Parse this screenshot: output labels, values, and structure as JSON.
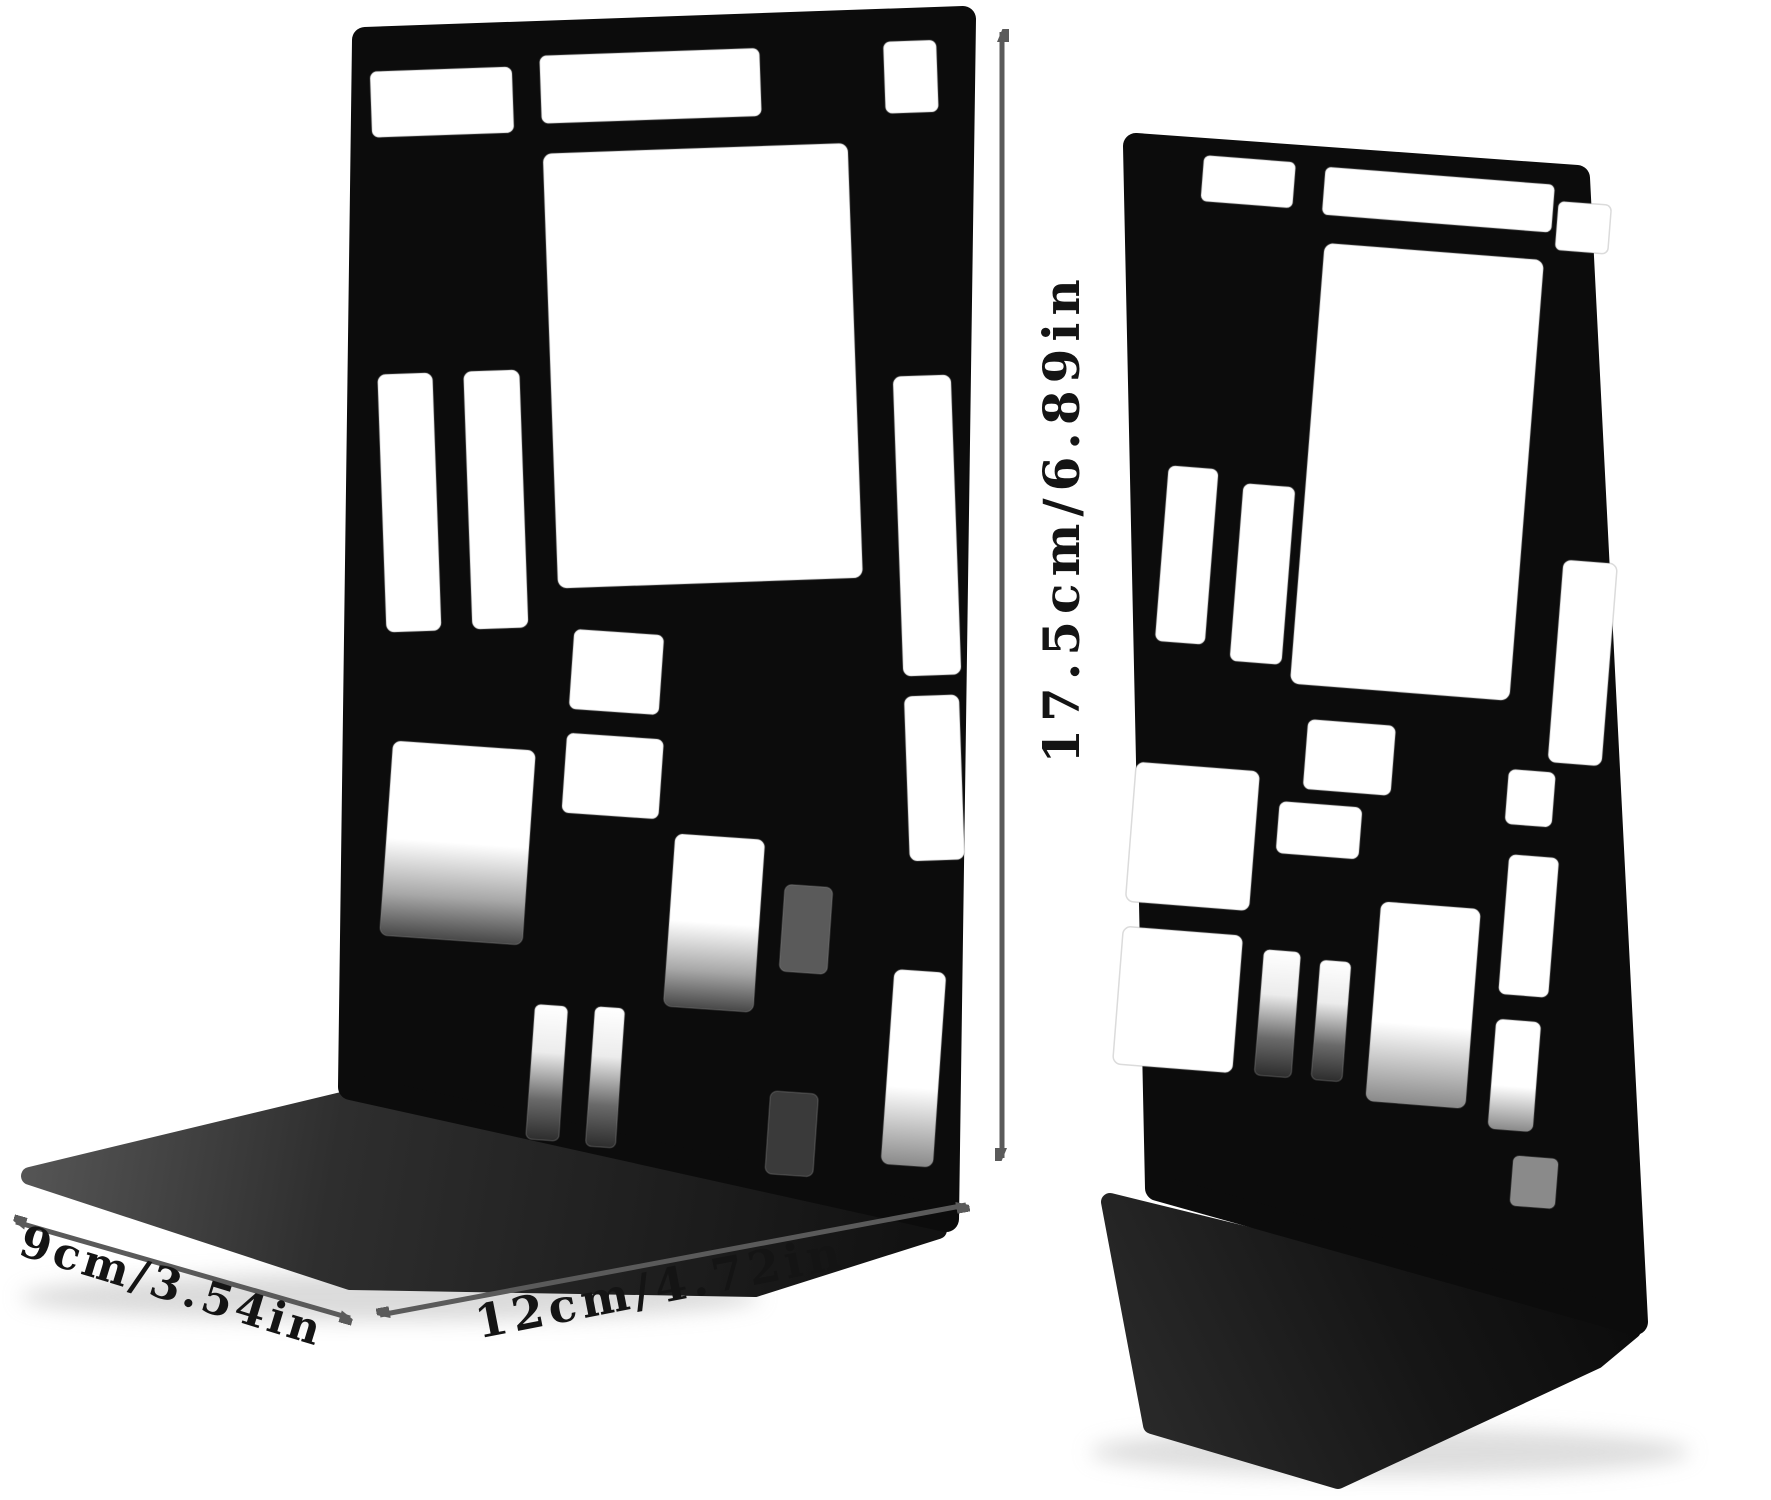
{
  "page": {
    "type": "product-photo",
    "background_color": "#ffffff",
    "subject": "pair of black metal bookends with Mondrian-style rectangular grid cutouts, shown with size annotations"
  },
  "dimensions": {
    "height": {
      "label": "17.5cm/6.89in",
      "cm": "17.5",
      "inches": "6.89"
    },
    "width": {
      "label": "12cm/4.72in",
      "cm": "12",
      "inches": "4.72"
    },
    "depth": {
      "label": "9cm/3.54in",
      "cm": "9",
      "inches": "3.54"
    }
  },
  "colors": {
    "bookend_black": "#0c0c0c",
    "base_sheen": "#4a4a4a",
    "dimension_arrow": "#5a5a5a",
    "label_text": "#141414"
  },
  "icons": {
    "height_arrow": "double-headed-vertical-arrow",
    "width_arrow": "double-headed-diagonal-arrow",
    "depth_arrow": "double-headed-diagonal-arrow"
  }
}
